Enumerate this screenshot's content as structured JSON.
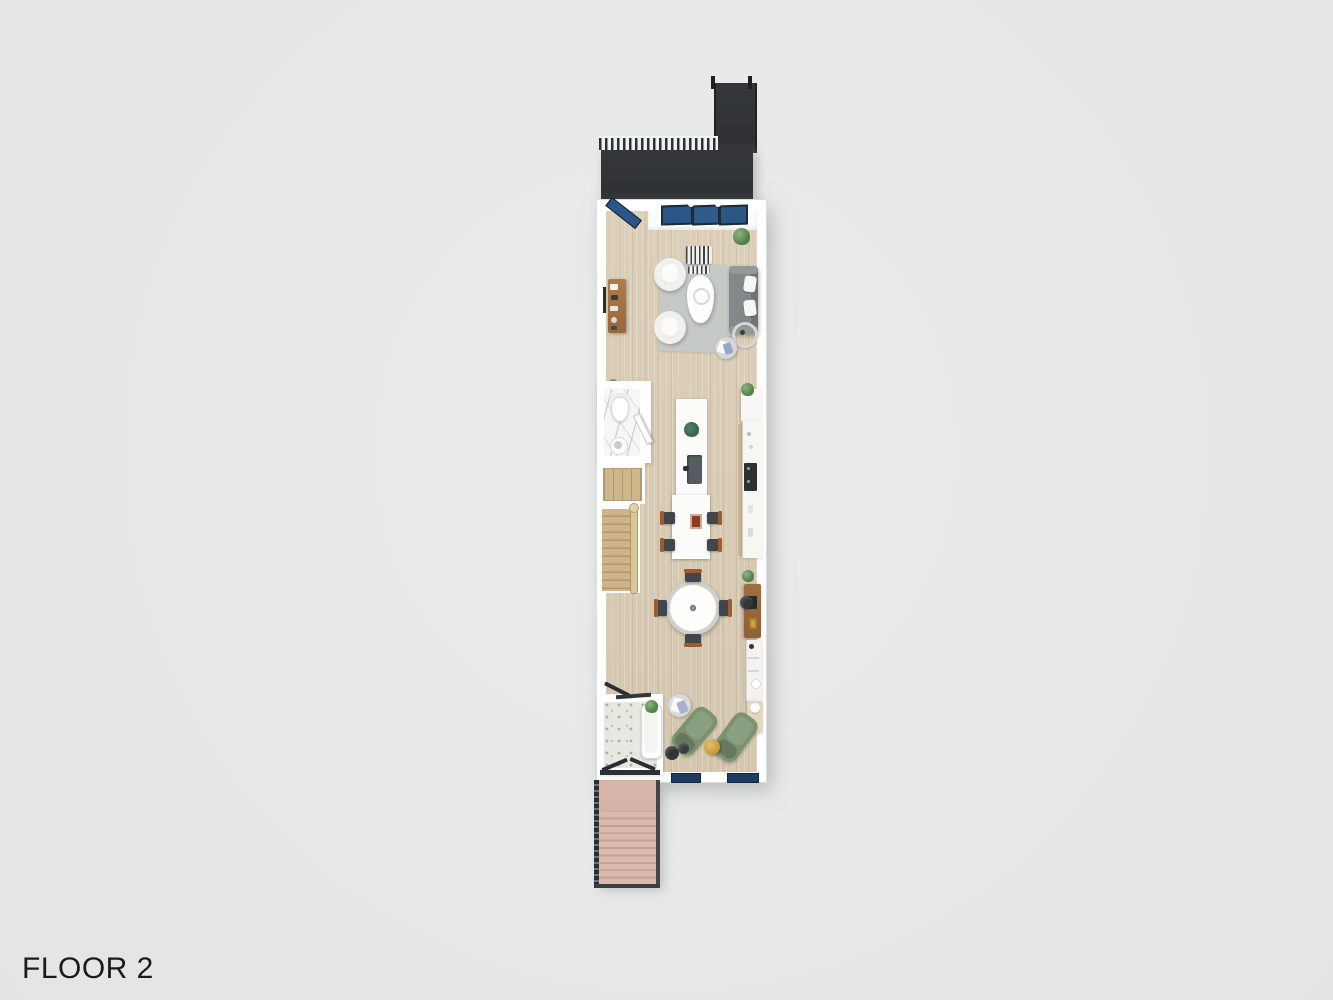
{
  "plan": {
    "floor_label": "FLOOR 2",
    "colors": {
      "background": "#e8eaea",
      "deck": "#313437",
      "wall": "#ffffff",
      "wood_floor": "#d8cbb4",
      "window_glass_blue": "#2c5685",
      "bottom_window_blue": "#1e3c62",
      "rug_gray": "#c6cac7",
      "sofa_gray": "#84888b",
      "armchair_white": "#f1f0ec",
      "lounge_chair_green": "#7c9170",
      "exterior_stairs_pink": "#d7b3a8",
      "interior_stairs_wood": "#cdb289",
      "furniture_wood": "#a06e40",
      "island_white": "#fcfcfb",
      "marble_white": "#f6f6f5",
      "bath_tile": "#e6e9e2",
      "accent_gold": "#d2a445",
      "tray_red": "#8e3d24",
      "plant_green": "#5d8a54"
    },
    "areas": [
      "roof-deck",
      "living-room",
      "powder-room",
      "closet",
      "interior-staircase",
      "kitchen",
      "dining-area",
      "desk-nook",
      "bathroom",
      "lounge",
      "exterior-staircase"
    ],
    "objects": [
      "deck-railing",
      "glass-sliding-doors",
      "open-glass-door",
      "striped-bench",
      "sofa",
      "sofa-pillows",
      "armchairs",
      "coffee-table",
      "area-rug",
      "media-console",
      "wall-tv",
      "floor-lamp",
      "pouf-basket",
      "potted-plants",
      "toilet",
      "pedestal-sink",
      "bathroom-door",
      "wardrobe-closet",
      "staircase-railing",
      "kitchen-island",
      "island-sink",
      "island-plant",
      "red-tray",
      "bar-chairs",
      "counter-with-oven",
      "round-dining-table",
      "dining-chairs",
      "desk",
      "desk-chair",
      "desk-lamp",
      "laptop",
      "shelf-unit",
      "daybed-bench",
      "bathtub",
      "tile-floor",
      "chaise-lounges",
      "gold-side-table",
      "dark-stools",
      "towel-pouf",
      "exterior-stair-railings"
    ]
  }
}
